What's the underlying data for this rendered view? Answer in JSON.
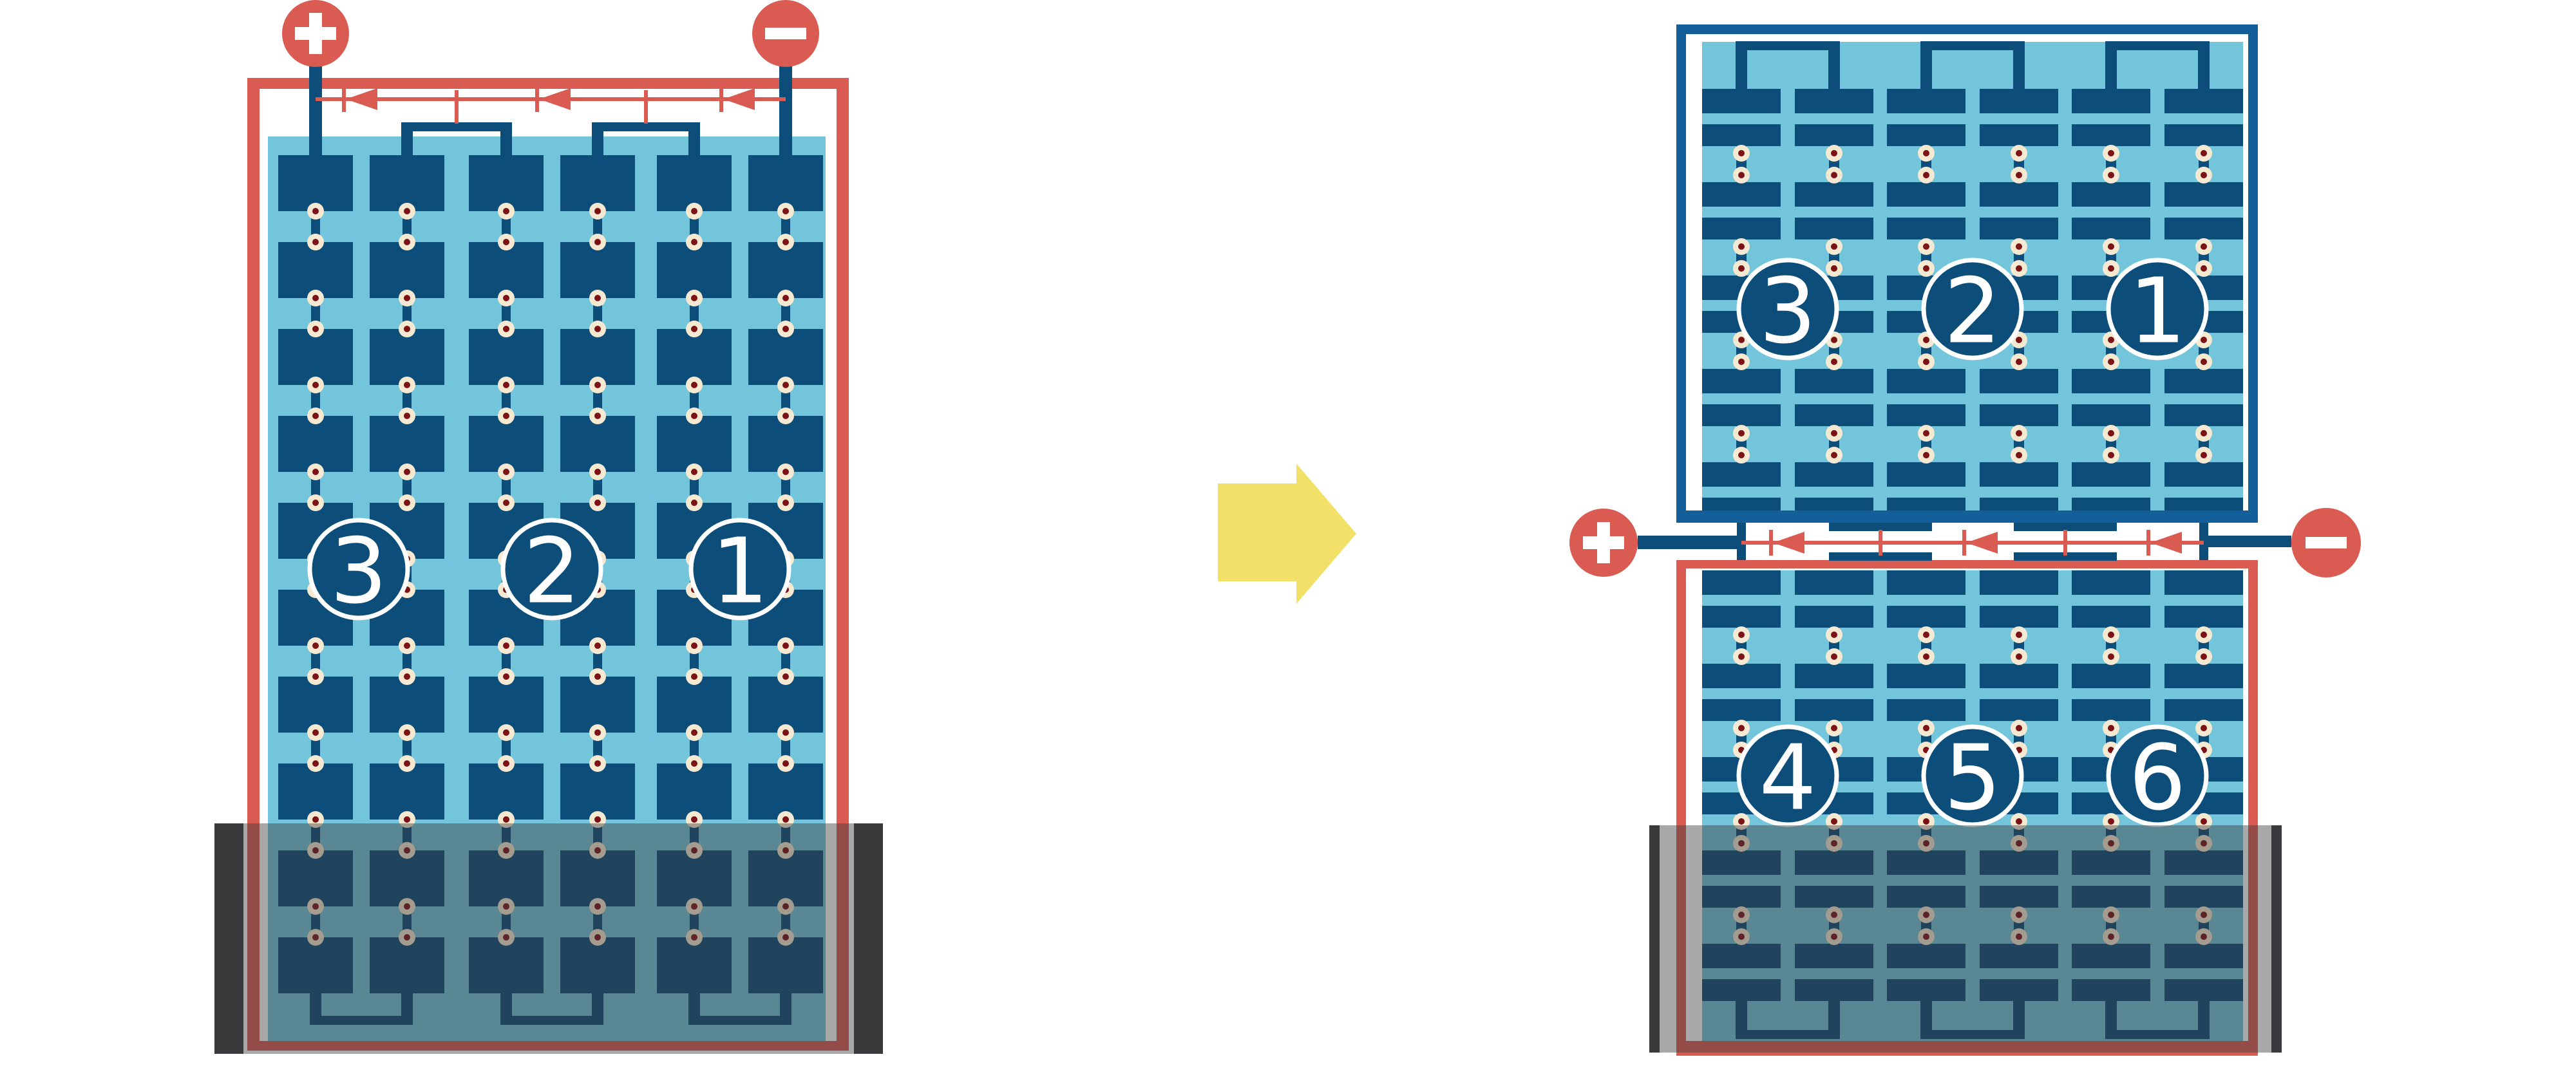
{
  "figure": {
    "description": "Battery cell series-connection diagram: single six-cell style battery transformed into a double-stack layout",
    "left_battery": {
      "positive_terminal": "+",
      "negative_terminal": "−",
      "cells": [
        "3",
        "2",
        "1"
      ]
    },
    "transform_arrow": {
      "direction": "right"
    },
    "right_battery": {
      "positive_terminal": "+",
      "negative_terminal": "−",
      "top_stack_cells": [
        "3",
        "2",
        "1"
      ],
      "bottom_stack_cells": [
        "4",
        "5",
        "6"
      ]
    }
  },
  "palette": {
    "red": "#D95B52",
    "dark_blue": "#0D4D7A",
    "frame_blue": "#135F99",
    "light_blue": "#72C5DB",
    "cream": "#F6E9D2",
    "dot_red": "#7B1215",
    "overlay_gray": "rgba(56,56,58,0.44)",
    "cap_gray": "#3A3A3C",
    "arrow_yellow": "#F2E169",
    "white": "#FFFFFF"
  }
}
